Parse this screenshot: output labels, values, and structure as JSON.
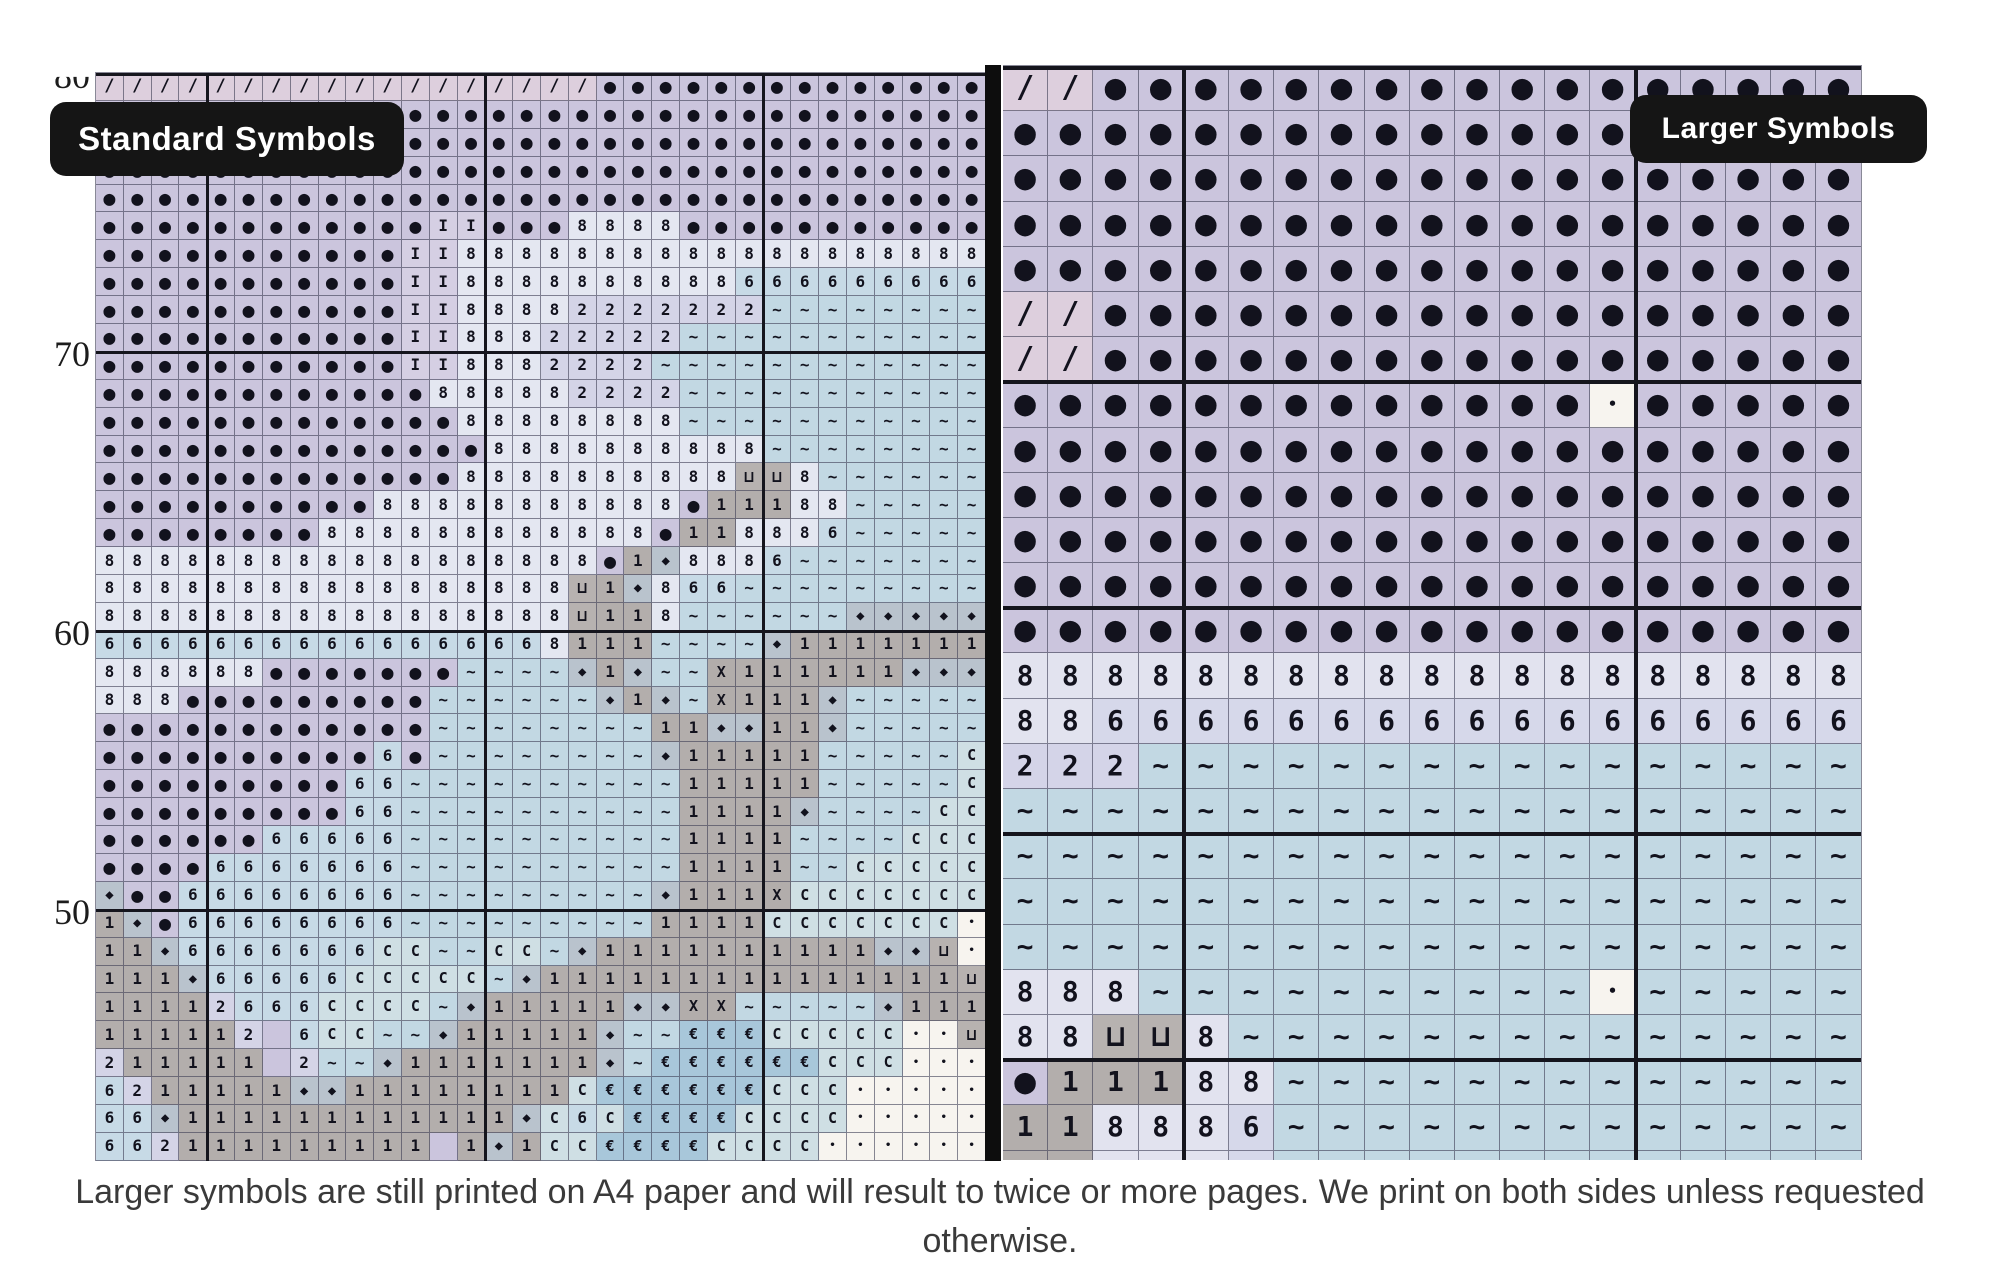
{
  "meta": {
    "description": "Cross-stitch pattern chart comparison: standard vs larger printed symbols"
  },
  "labels": {
    "standard": "Standard Symbols",
    "larger": "Larger Symbols"
  },
  "caption": "Larger symbols are still printed on A4 paper and will result to twice or more pages. We print on both sides unless requested otherwise.",
  "row_numbers": {
    "top_clipped": "80",
    "n70": "70",
    "n60": "60",
    "n50": "50"
  },
  "colors": {
    "symbol_ink": "#12121d",
    "thin_line": "rgba(58,58,82,0.6)",
    "thick_line": "#15151d",
    "pill_bg": "#151515",
    "pill_text": "#ffffff",
    "caption_text": "#3a3a3a",
    "cell_bg": {
      "/": "#ddcfdd",
      "o": "#cbc5dd",
      "I": "#d5cfe3",
      "8": "#e4e7f1",
      "6": "#c7dae6",
      "2": "#d4d4e7",
      "~": "#c2d8e3",
      "C": "#cfdfe4",
      "1": "#b3aeac",
      "d": "#b9c3cd",
      "u": "#b7b2b0",
      "X": "#b2adab",
      "e": "#a8c7da",
      ".": "#f7f4ef"
    },
    "right_bg_overrides": {
      "8": "#e2e3ef",
      "6": "#d6d8ea",
      "2": "#d4d4e8"
    }
  },
  "glyphs": {
    "/": "/",
    "o": "●",
    "I": "I",
    "8": "8",
    "6": "6",
    "2": "2",
    "~": "~",
    "C": "C",
    "1": "1",
    "d": "◆",
    "u": "⊔",
    "X": "X",
    "e": "€",
    ".": "•"
  },
  "left_grid": {
    "name": "standard-symbols-chart",
    "cols": 32,
    "rows": 39,
    "thick_col_boundaries": [
      4,
      14,
      24
    ],
    "thick_row_boundaries": [
      0,
      10,
      20,
      30
    ],
    "cells": [
      "//////////////////oooooooooooooo",
      "oooooooooooooooooooooooooooooooo",
      "oooooooooooooooooooooooooooooooo",
      "oooooooooooooooooooooooooooooooo",
      "oooooooooooooooooooooooooooooooo",
      "ooooooooooooIIooo8888ooooooooooo",
      "oooooooooooII8888888888888888888",
      "oooooooooooII8888888888666666666",
      "oooooooooooII88882222222~~~~~~~~",
      "oooooooooooII88822222~~~~~~~~~~~",
      "oooooooooooII8882222~~~~~~~~~~~~",
      "oooooooooooo888882222~~~~~~~~~~~",
      "ooooooooooooo88888888~~~~~~~~~~~",
      "oooooooooooooo8888888888~~~~~~~~",
      "ooooooooooooo8888888888uu8~~~~~~",
      "oooooooooo88888888888o11188~~~~~",
      "oooooooo888888888888o118886~~~~~",
      "888888888888888888o1d8886~~~~~~~",
      "88888888888888888u1d866~~~~~~~~~",
      "88888888888888888u118~~~~~~ddddd",
      "66666666666666668111~~~~d1111111",
      "888888ooooooo~~~~d1d~~X111111ddd",
      "888ooooooooo~~~~~~d1d~X111d~~~~~",
      "oooooooooooo~~~~~~~~11dd11d~~~~~",
      "oooooooooo6o~~~~~~~~d11111~~~~~C",
      "ooooooooo66~~~~~~~~~~11111~~~~~C",
      "ooooooooo66~~~~~~~~~~1111d~~~~CC",
      "oooooo66666~~~~~~~~~~1111~~~~CCC",
      "oooo6666666~~~~~~~~~~1111~~CCCCC",
      "doo66666666~~~~~~~~~d111XCCCCCCC",
      "1do66666666~~~~~~~~~1111CCCCCCC.",
      "11d6666666CC~~CC~d1111111111ddu.",
      "111d66666CCCCC~d111111111111111u",
      "11112666CCCC~d11111ddXX~~~~~d111",
      "111112 6CC~~d11111d~~eeeCCCCC..u1",
      "211111 2~~d1111111d~eeeeeeCCC...u",
      "6211111dd11111111CeeeeeeCCC.....",
      "66d111111111111dC6CeeeeCCCC.....",
      "662111111111 1d1CCeeeeCCCC......."
    ],
    "symbol_sizes": {
      "/": 17,
      "o": 20,
      "I": 16,
      "8": 16,
      "6": 16,
      "2": 16,
      "~": 16,
      "C": 15,
      "1": 16,
      "d": 14,
      "u": 16,
      "X": 15,
      "e": 15,
      ".": 10
    }
  },
  "right_grid": {
    "name": "larger-symbols-chart",
    "cols": 19,
    "rows": 25,
    "thick_col_boundaries": [
      4,
      14
    ],
    "thick_row_boundaries": [
      0,
      7,
      12,
      17,
      22
    ],
    "cells": [
      "//ooooooooooooooooo",
      "ooooooooooooooooooo",
      "ooooooooooooooooooo",
      "ooooooooooooooooooo",
      "ooooooooooooooooooo",
      "//ooooooooooooooooo",
      "//ooooooooooooooooo",
      "ooooooooooooo.ooooo",
      "ooooooooooooooooooo",
      "ooooooooooooooooooo",
      "ooooooooooooooooooo",
      "ooooooooooooooooooo",
      "ooooooooooooooooooo",
      "8888888888888888888",
      "8866666666666666666",
      "222~~~~~~~~~~~~~~~~",
      "~~~~~~~~~~~~~~~~~~~",
      "~~~~~~~~~~~~~~~~~~~",
      "~~~~~~~~~~~~~~~~~~~",
      "~~~~~~~~~~~~~~~~~~~",
      "888~~~~~~~~~~.~~~~~",
      "88uu8~~~~~~~~~~~~~~",
      "o11188~~~~~~~~~~~~~",
      "118886~~~~~~~~~~~~~",
      "118886~~~~~~~~~~~~~"
    ],
    "symbol_sizes": {
      "/": 30,
      "o": 36,
      "8": 28,
      "6": 28,
      "2": 28,
      "~": 28,
      "1": 28,
      "u": 30,
      ".": 15,
      "d": 26,
      "C": 26,
      "I": 28,
      "X": 26,
      "e": 26
    }
  },
  "layout_px": {
    "left": {
      "x": 95,
      "y": 72,
      "cell_w": 27.8125,
      "cell_h": 27.9
    },
    "right": {
      "x": 1003,
      "y": 65,
      "cell_w": 45.2,
      "cell_h": 45.2,
      "clip_h": 1095
    }
  }
}
